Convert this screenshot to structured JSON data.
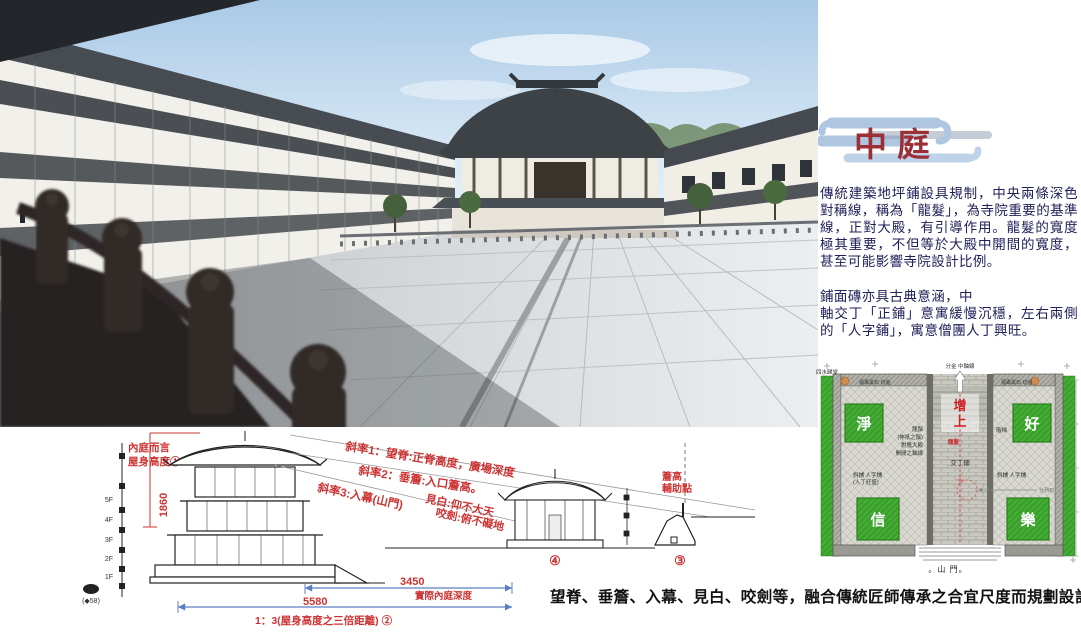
{
  "panel": {
    "title": "中庭",
    "para1": "傳統建築地坪鋪設具規制，中央兩條深色對稱線，稱為「龍髮」，為寺院重要的基準線，正對大殿，有引導作用。龍髮的寬度極其重要，不但等於大殿中開間的寬度，甚至可能影響寺院設計比例。",
    "para2_line1": "鋪面磚亦具古典意涵，中",
    "para2_rest": "軸交丁「正鋪」意寓緩慢沉穩，左右兩側的「人字鋪」，寓意僧團人丁興旺。"
  },
  "section": {
    "slope1": "斜率1：望脊:正脊高度，廣場深度",
    "slope2": "斜率2：垂簷:入口簷高。",
    "slope3": "斜率3:入幕(山門)",
    "jianbai": "見白:仰不大天",
    "yaojian": "咬劍:俯不礙地",
    "inner_label1": "內庭而言",
    "inner_label2": "屋身高度①",
    "height_value": "1860",
    "dim_top_value": "3450",
    "dim_top_label": "實際內庭深度",
    "dim_bottom_value": "5580",
    "ratio_note": "1：3(屋身高度之三倍距離) ②",
    "gate_number": "④",
    "slope_number": "③",
    "aux_line1": "簷高",
    "aux_line2": "輔助點",
    "floors": [
      "5F",
      "4F",
      "3F",
      "2F",
      "1F"
    ],
    "datum": "(◆58)"
  },
  "plan": {
    "axis_label": "分金 中軸線",
    "zengshang_1": "增",
    "zengshang_2": "上",
    "corner_top_left": "淨",
    "corner_top_right": "好",
    "corner_bottom_left": "信",
    "corner_bottom_right": "樂",
    "stone_left": "福專黑石 切邊",
    "stone_right": "福專黑石 切邊",
    "longxu_l1": "龍鬚",
    "longxu_l2": "(神祇之鬚)",
    "longxu_l3": "對應大殿",
    "longxu_l4": "開間之軸線",
    "stairs": "階梯",
    "longfa_red": "龍髮",
    "jiaoding": "交丁鋪",
    "herringbone_left": "斜鋪 人字鋪",
    "herringbone_left_note": "(人丁旺盛)",
    "herringbone_right": "斜鋪 人字鋪",
    "circle_note": "分列石",
    "gate": "。山 門。",
    "sishui": "四水歸堂"
  },
  "caption": "望脊、垂簷、入幕、見白、咬劍等，融合傳統匠師傳承之合宜尺度而規劃設計",
  "colors": {
    "title_red": "#9c2f35",
    "annotation_red": "#cc3333",
    "body_text": "#20205a",
    "dim_blue": "#5b7fc4",
    "grass_green": "#3aa22c"
  }
}
